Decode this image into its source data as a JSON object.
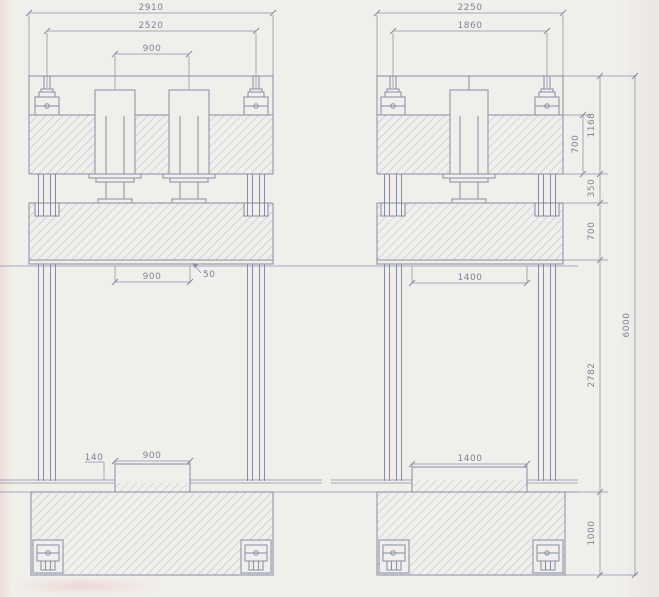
{
  "drawing": {
    "left_press": {
      "overall_width": "2910",
      "column_spacing": "2520",
      "cylinder_spacing": "900",
      "bolster_plate_thickness": "50",
      "die_opening_width": "900",
      "pad_width": "900",
      "pad_height": "140"
    },
    "right_press": {
      "overall_width": "2250",
      "column_spacing": "1860",
      "die_opening_width": "1400",
      "pad_width": "1400"
    },
    "side_dims": {
      "crosshead_height": "700",
      "head_assembly_height": "1168",
      "open_gap": "350",
      "platen_height": "700",
      "column_clear_height": "2782",
      "base_height": "1000",
      "overall_height": "6000"
    },
    "colors": {
      "paper": "#f1efeb",
      "line": "#858da0",
      "hatch": "#9aa3b6",
      "text": "#7b8497"
    }
  }
}
